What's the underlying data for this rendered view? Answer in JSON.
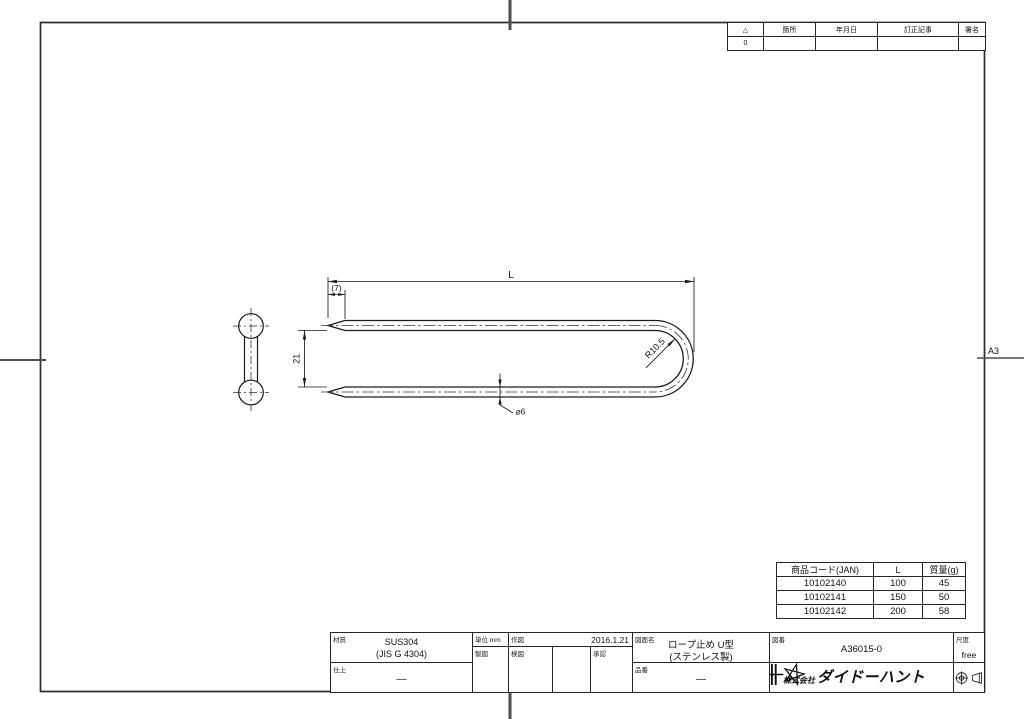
{
  "sheet": {
    "size_label": "A3"
  },
  "revision_table": {
    "headers": [
      "△",
      "箇所",
      "年月日",
      "訂正記事",
      "署名"
    ],
    "row": [
      "0",
      "",
      "",
      "",
      ""
    ]
  },
  "drawing": {
    "dim_length": "L",
    "dim_tip": "(7)",
    "dim_width": "21",
    "dim_radius": "R10.5",
    "dim_diameter": "⌀6"
  },
  "product_table": {
    "headers": [
      "商品コード(JAN)",
      "L",
      "質量(g)"
    ],
    "rows": [
      [
        "10102140",
        "100",
        "45"
      ],
      [
        "10102141",
        "150",
        "50"
      ],
      [
        "10102142",
        "200",
        "58"
      ]
    ]
  },
  "title_block": {
    "material_label": "材質",
    "material_value": "SUS304",
    "material_spec": "(JIS G 4304)",
    "finish_label": "仕上",
    "finish_value": "—",
    "unit_label": "単位 mm",
    "draft_label": "製図",
    "drawn_label": "作図",
    "drawn_date": "2016.1.21",
    "check_label": "検図",
    "approve_label": "承認",
    "name_label": "図面名",
    "name_value": "ロープ止め U型",
    "name_sub": "(ステンレス製)",
    "part_label": "品番",
    "part_value": "—",
    "dwgno_label": "図番",
    "dwgno_value": "A36015-0",
    "scale_label": "尺度",
    "scale_value": "free",
    "company_prefix": "株式会社",
    "company_name": "ダイドーハント"
  }
}
